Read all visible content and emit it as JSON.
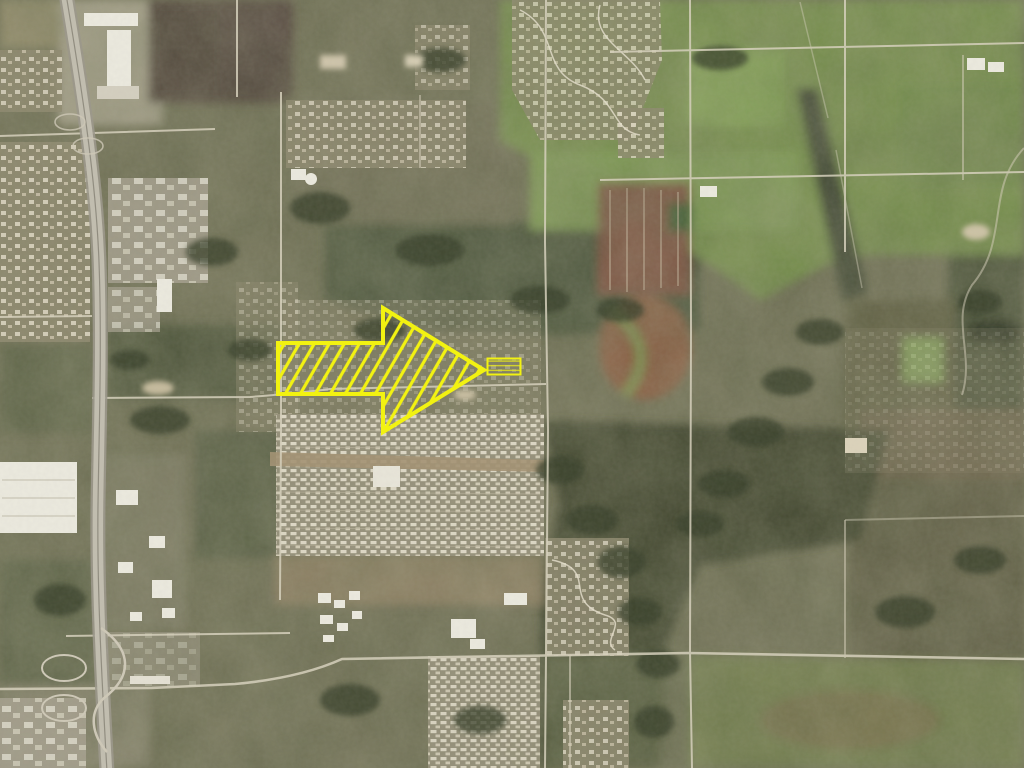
{
  "map": {
    "type": "satellite-aerial",
    "annotation": {
      "color": "#f2f211",
      "arrow_name": "site-pointer-arrow",
      "arrow_direction": "east",
      "arrow_style": "diagonal-hatched outline arrow",
      "parcel_name": "highlighted-parcel",
      "parcel_style": "small hatched outline rectangle at arrow tip"
    }
  }
}
